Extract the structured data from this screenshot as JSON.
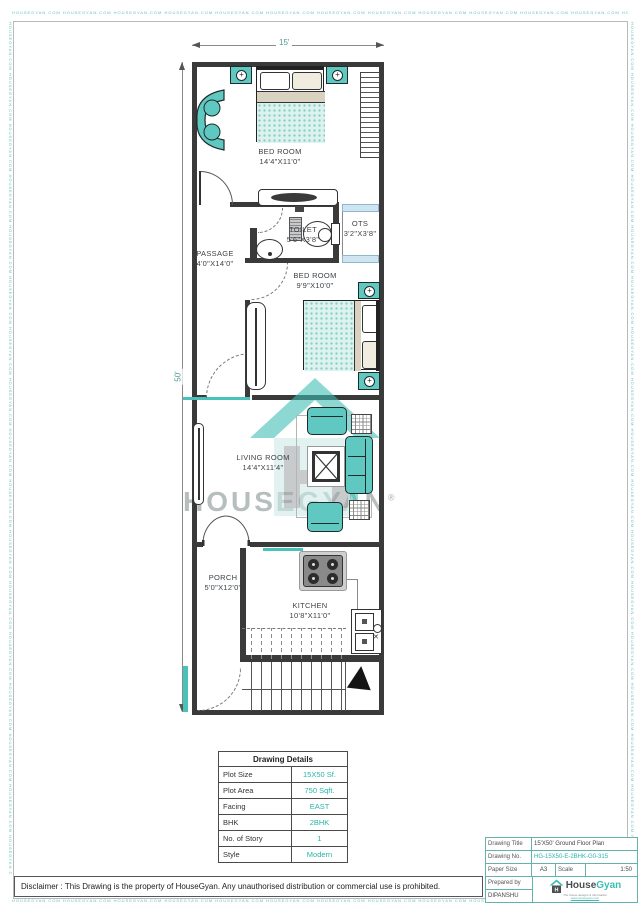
{
  "watermark_border": {
    "repeat_text": "HOUSEGYAN.COM"
  },
  "dimensions": {
    "width_label": "15'",
    "height_label": "50'"
  },
  "rooms": [
    {
      "name": "BED ROOM",
      "size": "14'4\"X11'0\""
    },
    {
      "name": "TOILET",
      "size": "5'6\"X3'8\""
    },
    {
      "name": "OTS",
      "size": "3'2\"X3'8\""
    },
    {
      "name": "PASSAGE",
      "size": "4'0\"X14'0\""
    },
    {
      "name": "BED ROOM",
      "size": "9'9\"X10'0\""
    },
    {
      "name": "LIVING ROOM",
      "size": "14'4\"X11'4\""
    },
    {
      "name": "PORCH",
      "size": "5'0\"X12'0\""
    },
    {
      "name": "KITCHEN",
      "size": "10'8\"X11'0\""
    }
  ],
  "watermark": {
    "brand": "HOUSEGYAN",
    "registered": "®"
  },
  "details_table": {
    "title": "Drawing Details",
    "rows": [
      {
        "label": "Plot Size",
        "value": "15X50 Sf."
      },
      {
        "label": "Plot Area",
        "value": "750 Sqft."
      },
      {
        "label": "Facing",
        "value": "EAST"
      },
      {
        "label": "BHK",
        "value": "2BHK"
      },
      {
        "label": "No. of Story",
        "value": "1"
      },
      {
        "label": "Style",
        "value": "Modern"
      }
    ]
  },
  "title_block": {
    "drawing_title_label": "Drawing Title",
    "drawing_title": "15'X50' Ground Floor Plan",
    "drawing_no_label": "Drawing No.",
    "drawing_no": "HG-15X50-E-2BHK-G0-315",
    "paper_size_label": "Paper Size",
    "paper_size": "A3",
    "scale_label": "Scale",
    "scale": "1:50",
    "prepared_by_label": "Prepared by",
    "prepared_by": "DIPANSHU",
    "logo_text_house": "House",
    "logo_text_gyan": "Gyan",
    "logo_letter": "H",
    "logo_tagline": "The house designs & information",
    "logo_link": "www.housegyan.com"
  },
  "disclaimer": "Disclaimer : This Drawing is the property of HouseGyan. Any unauthorised distribution or commercial use is prohibited.",
  "colors": {
    "accent_teal": "#3ebdb4",
    "furniture_teal": "#5fc9c1",
    "window_blue": "#cfe6f2"
  }
}
